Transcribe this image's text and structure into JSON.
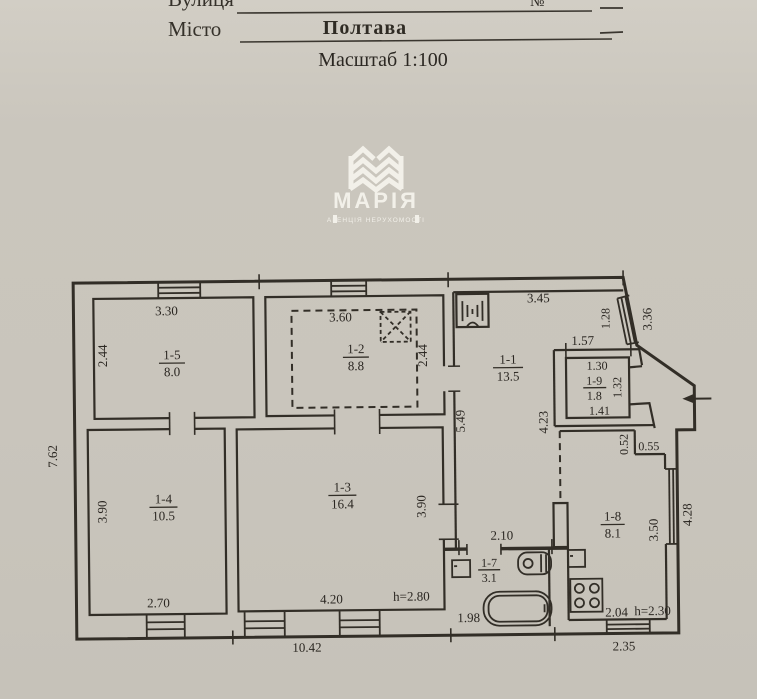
{
  "header": {
    "street_label": "Вулиця",
    "number_label": "№",
    "city_label": "Місто",
    "city_value": "Полтава",
    "scale": "Масштаб 1:100"
  },
  "logo": {
    "name": "МАРІЯ",
    "tagline": "АГЕНЦІЯ НЕРУХОМОСТІ"
  },
  "colors": {
    "paper": "#c9c5bc",
    "ink": "#322e27",
    "logo_text": "#f2f0e9"
  },
  "plan": {
    "rooms": {
      "r11": {
        "id": "1-1",
        "area": "13.5"
      },
      "r12": {
        "id": "1-2",
        "area": "8.8"
      },
      "r13": {
        "id": "1-3",
        "area": "16.4"
      },
      "r14": {
        "id": "1-4",
        "area": "10.5"
      },
      "r15": {
        "id": "1-5",
        "area": "8.0"
      },
      "r17": {
        "id": "1-7",
        "area": "3.1"
      },
      "r18": {
        "id": "1-8",
        "area": "8.1"
      },
      "r19": {
        "id": "1-9",
        "area": "1.8"
      }
    },
    "dims": {
      "overall_left": "7.62",
      "overall_bottom": "10.42",
      "porch_bottom": "2.35",
      "r15_top": "3.30",
      "r15_left": "2.44",
      "r12_top": "3.60",
      "r12_right": "2.44",
      "r11_top": "3.45",
      "r11_left": "5.49",
      "r11_right_win": "1.28",
      "r11_right_total": "3.36",
      "r19_above": "1.57",
      "r19_top": "1.30",
      "r19_bottom": "1.41",
      "r19_right": "1.32",
      "r14_left": "3.90",
      "r14_bottom": "2.70",
      "r13_bottom": "4.20",
      "r13_right": "3.90",
      "r13_height": "h=2.80",
      "hall_width": "2.10",
      "hall_length": "4.23",
      "r17_bottom": "1.98",
      "r18_step_v": "0.52",
      "r18_step_h": "0.55",
      "r18_right": "3.50",
      "r18_right_outer": "4.28",
      "r18_bottom": "2.04",
      "r18_height": "h=2.30"
    }
  }
}
